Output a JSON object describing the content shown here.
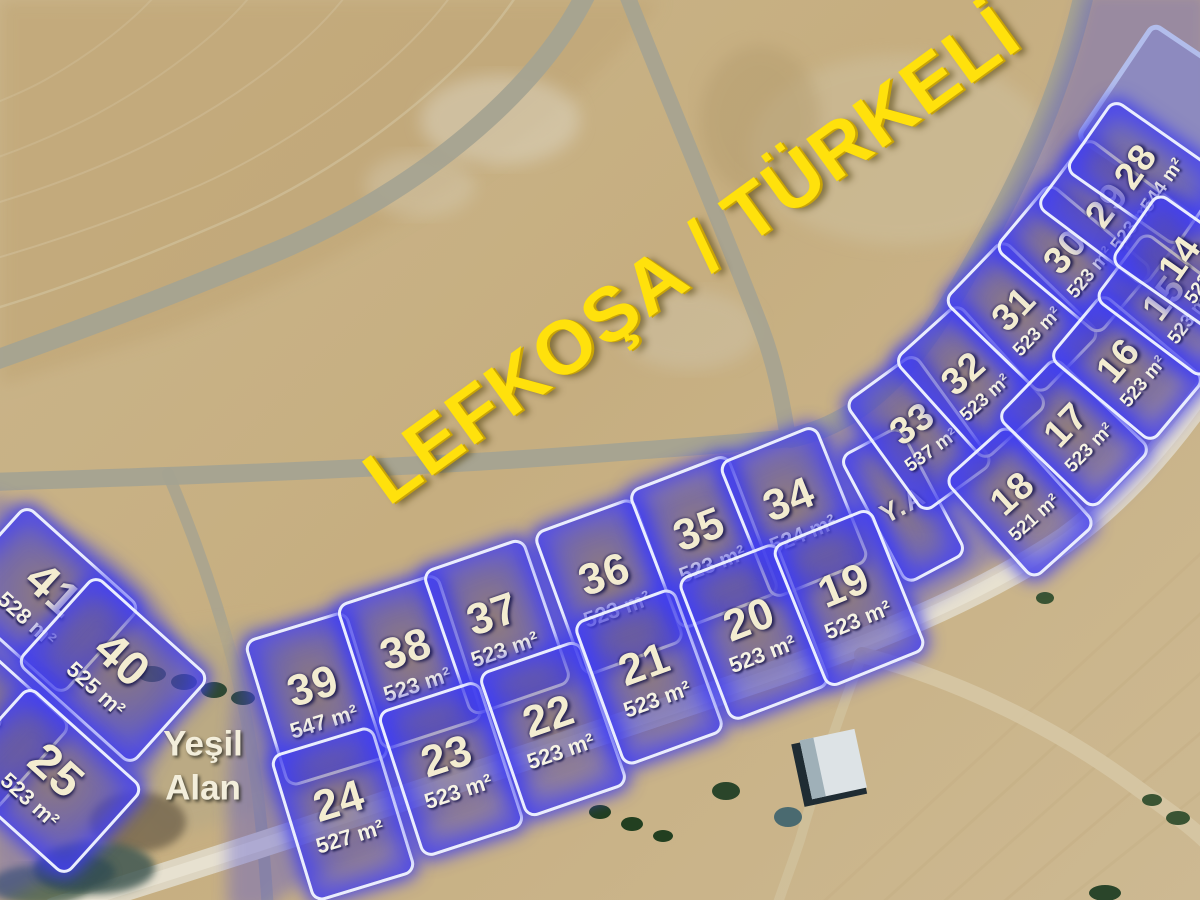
{
  "title": "LEFKOŞA / TÜRKELİ",
  "labels": {
    "green_area_line1": "Yeşil",
    "green_area_line2": "Alan"
  },
  "colors": {
    "title_yellow": "#ffe10c",
    "plot_glow_blue": "#4242e8",
    "plot_number_cream": "#f3ecd0",
    "reserved_block_purple": "#8d8ac0",
    "photo_tan": "#c9b489"
  },
  "plots": [
    {
      "num": "41",
      "area": "528 m²",
      "x": 41,
      "y": 597,
      "w": 150,
      "h": 114,
      "rot": 42,
      "style": "left"
    },
    {
      "num": "40",
      "area": "525 m²",
      "x": 110,
      "y": 667,
      "w": 150,
      "h": 114,
      "rot": 42,
      "style": "left"
    },
    {
      "num": "26",
      "area": "",
      "x": -28,
      "y": 715,
      "w": 150,
      "h": 114,
      "rot": 42,
      "style": "left"
    },
    {
      "num": "25",
      "area": "523 m²",
      "x": 44,
      "y": 778,
      "w": 150,
      "h": 114,
      "rot": 42,
      "style": "left"
    },
    {
      "num": "39",
      "area": "547 m²",
      "x": 314,
      "y": 696,
      "w": 102,
      "h": 148,
      "rot": -17,
      "style": "strip"
    },
    {
      "num": "38",
      "area": "523 m²",
      "x": 407,
      "y": 659,
      "w": 102,
      "h": 148,
      "rot": -18,
      "style": "strip"
    },
    {
      "num": "37",
      "area": "523 m²",
      "x": 494,
      "y": 624,
      "w": 102,
      "h": 148,
      "rot": -19,
      "style": "strip"
    },
    {
      "num": "36",
      "area": "523 m²",
      "x": 606,
      "y": 584,
      "w": 102,
      "h": 148,
      "rot": -20,
      "style": "strip"
    },
    {
      "num": "35",
      "area": "523 m²",
      "x": 701,
      "y": 539,
      "w": 102,
      "h": 144,
      "rot": -21,
      "style": "strip"
    },
    {
      "num": "34",
      "area": "524 m²",
      "x": 791,
      "y": 509,
      "w": 100,
      "h": 142,
      "rot": -22,
      "style": "strip"
    },
    {
      "num": "Y.A",
      "area": "",
      "x": 900,
      "y": 502,
      "w": 64,
      "h": 140,
      "rot": -28,
      "style": "ya"
    },
    {
      "num": "33",
      "area": "537 m²",
      "x": 916,
      "y": 430,
      "w": 82,
      "h": 132,
      "rot": -36,
      "style": "arc"
    },
    {
      "num": "32",
      "area": "523 m²",
      "x": 968,
      "y": 379,
      "w": 82,
      "h": 132,
      "rot": -42,
      "style": "arc"
    },
    {
      "num": "31",
      "area": "523 m²",
      "x": 1019,
      "y": 314,
      "w": 82,
      "h": 132,
      "rot": -46,
      "style": "arc"
    },
    {
      "num": "30",
      "area": "523 m²",
      "x": 1071,
      "y": 256,
      "w": 82,
      "h": 132,
      "rot": -50,
      "style": "arc"
    },
    {
      "num": "29",
      "area": "523 m²",
      "x": 1113,
      "y": 209,
      "w": 82,
      "h": 132,
      "rot": -53,
      "style": "arc"
    },
    {
      "num": "28",
      "area": "544 m²",
      "x": 1142,
      "y": 170,
      "w": 82,
      "h": 132,
      "rot": -55,
      "style": "arc"
    },
    {
      "num": "24",
      "area": "527 m²",
      "x": 340,
      "y": 811,
      "w": 102,
      "h": 148,
      "rot": -17,
      "style": "strip"
    },
    {
      "num": "23",
      "area": "523 m²",
      "x": 448,
      "y": 766,
      "w": 102,
      "h": 148,
      "rot": -18,
      "style": "strip"
    },
    {
      "num": "22",
      "area": "523 m²",
      "x": 550,
      "y": 726,
      "w": 102,
      "h": 148,
      "rot": -19,
      "style": "strip"
    },
    {
      "num": "21",
      "area": "523 m²",
      "x": 646,
      "y": 674,
      "w": 102,
      "h": 148,
      "rot": -20,
      "style": "strip"
    },
    {
      "num": "20",
      "area": "523 m²",
      "x": 751,
      "y": 629,
      "w": 102,
      "h": 148,
      "rot": -21,
      "style": "strip"
    },
    {
      "num": "19",
      "area": "523 m²",
      "x": 846,
      "y": 595,
      "w": 102,
      "h": 148,
      "rot": -22,
      "style": "strip"
    },
    {
      "num": "18",
      "area": "521 m²",
      "x": 1017,
      "y": 499,
      "w": 80,
      "h": 130,
      "rot": -42,
      "style": "arc"
    },
    {
      "num": "17",
      "area": "523 m²",
      "x": 1071,
      "y": 430,
      "w": 80,
      "h": 130,
      "rot": -46,
      "style": "arc"
    },
    {
      "num": "16",
      "area": "523 m²",
      "x": 1124,
      "y": 365,
      "w": 80,
      "h": 130,
      "rot": -50,
      "style": "arc"
    },
    {
      "num": "15",
      "area": "523 m²",
      "x": 1170,
      "y": 302,
      "w": 80,
      "h": 130,
      "rot": -53,
      "style": "arc"
    },
    {
      "num": "14",
      "area": "523 m²",
      "x": 1186,
      "y": 262,
      "w": 80,
      "h": 130,
      "rot": -55,
      "style": "arc"
    }
  ]
}
